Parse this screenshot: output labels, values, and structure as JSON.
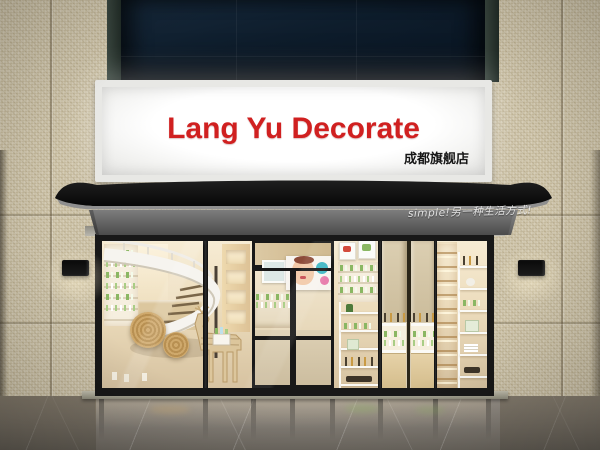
{
  "scene": {
    "type": "storefront-photo",
    "sign": {
      "title": "Lang Yu Decorate",
      "subtitle": "成都旗舰店"
    },
    "awning": {
      "slogan": "simple!另一种生活方式!"
    },
    "palette": {
      "wall_tile": "#cdc3a8",
      "top_panel": "#0e1e2e",
      "sign_red": "#d02020",
      "sign_sub": "#161616",
      "awning_roof": "#0e0e0e",
      "awning_fabric": "#686868",
      "slogan_white": "#eeeeee",
      "frame_black": "#181818",
      "interior_warm": "#eeddbe",
      "wood_light": "#d9c39c",
      "product_green": "#8ab763",
      "floor_gray": "#89837b"
    }
  }
}
